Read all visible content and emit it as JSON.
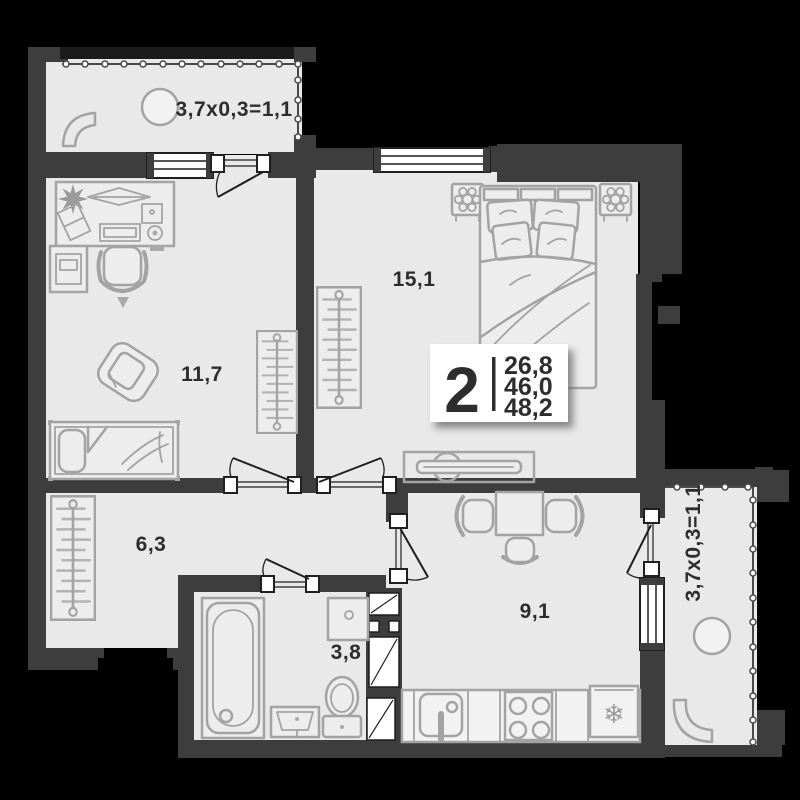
{
  "floorplan": {
    "summary": {
      "rooms_count": "2",
      "area_living": "26,8",
      "area_total": "46,0",
      "area_with_balcony": "48,2"
    },
    "room_labels": {
      "bedroom": "15,1",
      "living": "11,7",
      "hall": "6,3",
      "bath": "3,8",
      "kitchen": "9,1"
    },
    "balcony_top_label": "3,7x0,3=1,1",
    "balcony_right_label": "3,7x0,3=1,1",
    "icons": {
      "fridge_snowflake": "❄"
    },
    "colors": {
      "background": "#000000",
      "wall": "#3d3d3d",
      "wall_outer": "#1b1b1b",
      "floor": "#e9e9e9",
      "furniture_stroke": "#a3a3a3",
      "label_text": "#2d2d2d",
      "summary_bg": "#ffffff"
    }
  }
}
